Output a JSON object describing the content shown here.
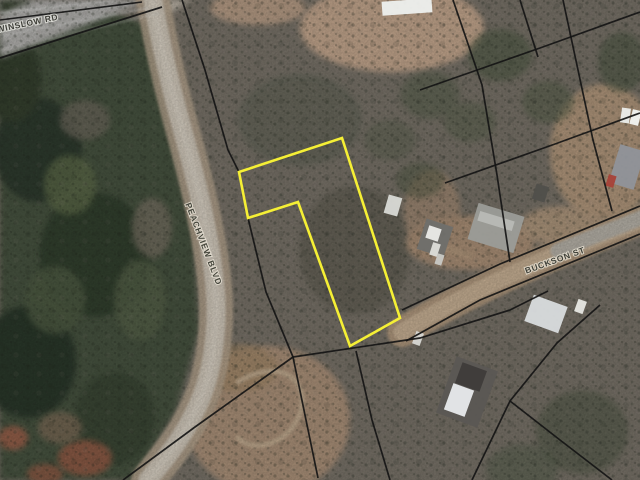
{
  "map": {
    "width": 640,
    "height": 480,
    "background": "#797369",
    "boundary_color": "#151515",
    "highlight_color": "#f5ef35",
    "labels": [
      {
        "name": "road-label-winslow",
        "text": "WINSLOW RD",
        "x": 28,
        "y": 26,
        "rotate": -12,
        "size": 8.5,
        "spacing": 0.6,
        "fill": "#3e3e38",
        "halo": "rgba(225,225,218,0.85)"
      },
      {
        "name": "road-label-peachview",
        "text": "PEACHVIEW BLVD",
        "x": 201,
        "y": 245,
        "rotate": 69,
        "size": 8.5,
        "spacing": 0.8,
        "fill": "#45463c",
        "halo": "rgba(232,226,214,0.8)"
      },
      {
        "name": "road-label-buckson",
        "text": "BUCKSON ST",
        "x": 556,
        "y": 263,
        "rotate": -20,
        "size": 8.5,
        "spacing": 0.7,
        "fill": "#3f4038",
        "halo": "rgba(233,226,212,0.8)"
      }
    ],
    "regions": [
      {
        "name": "forest-west",
        "type": "polygon",
        "points": "0,26 95,6 150,26 163,95 193,235 199,330 176,410 133,480 0,480",
        "fill": "#47523f",
        "opacity": 1
      },
      {
        "name": "forest-dark-blob",
        "type": "ellipse",
        "cx": 38,
        "cy": 150,
        "rx": 44,
        "ry": 52,
        "fill": "#2f3b2d",
        "opacity": 1
      },
      {
        "name": "forest-dark-blob",
        "type": "ellipse",
        "cx": 95,
        "cy": 255,
        "rx": 56,
        "ry": 62,
        "fill": "#333f2e",
        "opacity": 1
      },
      {
        "name": "forest-dark-blob",
        "type": "ellipse",
        "cx": 28,
        "cy": 362,
        "rx": 48,
        "ry": 56,
        "fill": "#2b372b",
        "opacity": 1
      },
      {
        "name": "forest-dark-blob",
        "type": "ellipse",
        "cx": 115,
        "cy": 418,
        "rx": 40,
        "ry": 46,
        "fill": "#3a4635",
        "opacity": 1
      },
      {
        "name": "forest-dark-blob",
        "type": "ellipse",
        "cx": 12,
        "cy": 80,
        "rx": 30,
        "ry": 42,
        "fill": "#36412f",
        "opacity": 1
      },
      {
        "name": "forest-light-blob",
        "type": "ellipse",
        "cx": 70,
        "cy": 185,
        "rx": 26,
        "ry": 30,
        "fill": "#5d6b48",
        "opacity": 0.8
      },
      {
        "name": "forest-light-blob",
        "type": "ellipse",
        "cx": 140,
        "cy": 300,
        "rx": 26,
        "ry": 40,
        "fill": "#57624a",
        "opacity": 0.8
      },
      {
        "name": "forest-light-blob",
        "type": "ellipse",
        "cx": 55,
        "cy": 300,
        "rx": 30,
        "ry": 34,
        "fill": "#4e5a43",
        "opacity": 0.9
      },
      {
        "name": "forest-grey-patch",
        "type": "ellipse",
        "cx": 85,
        "cy": 120,
        "rx": 25,
        "ry": 20,
        "fill": "#6c675c",
        "opacity": 0.8
      },
      {
        "name": "forest-grey-patch",
        "type": "ellipse",
        "cx": 152,
        "cy": 228,
        "rx": 20,
        "ry": 30,
        "fill": "#766f62",
        "opacity": 0.8
      },
      {
        "name": "red-trees",
        "type": "ellipse",
        "cx": 85,
        "cy": 458,
        "rx": 27,
        "ry": 18,
        "fill": "#8a5a45",
        "opacity": 1
      },
      {
        "name": "red-trees",
        "type": "ellipse",
        "cx": 13,
        "cy": 438,
        "rx": 15,
        "ry": 12,
        "fill": "#935f48",
        "opacity": 1
      },
      {
        "name": "red-trees",
        "type": "ellipse",
        "cx": 45,
        "cy": 474,
        "rx": 18,
        "ry": 10,
        "fill": "#8a5a45",
        "opacity": 0.9
      },
      {
        "name": "bare-patch",
        "type": "ellipse",
        "cx": 60,
        "cy": 428,
        "rx": 22,
        "ry": 16,
        "fill": "#7c6a56",
        "opacity": 0.8
      },
      {
        "name": "highway-surface",
        "type": "polygon",
        "points": "0,0 150,0 0,58",
        "fill": "#b2b1ae",
        "opacity": 1
      },
      {
        "name": "road-junction",
        "type": "polygon",
        "points": "146,0 192,0 168,14",
        "fill": "#bdb5a8",
        "opacity": 1
      },
      {
        "name": "corner-trees",
        "type": "polygon",
        "points": "0,0 34,0 0,14",
        "fill": "#3c4636",
        "opacity": 1
      },
      {
        "name": "field-top-middle",
        "type": "ellipse",
        "cx": 392,
        "cy": 28,
        "rx": 92,
        "ry": 44,
        "fill": "#c3a68d",
        "opacity": 1
      },
      {
        "name": "field-top-left",
        "type": "ellipse",
        "cx": 258,
        "cy": 8,
        "rx": 48,
        "ry": 17,
        "fill": "#bda189",
        "opacity": 0.9
      },
      {
        "name": "scrub-mid",
        "type": "ellipse",
        "cx": 300,
        "cy": 120,
        "rx": 62,
        "ry": 46,
        "fill": "#5c6152",
        "opacity": 0.55
      },
      {
        "name": "scrub-mid",
        "type": "ellipse",
        "cx": 355,
        "cy": 250,
        "rx": 56,
        "ry": 64,
        "fill": "#56544a",
        "opacity": 0.5
      },
      {
        "name": "yard-right",
        "type": "ellipse",
        "cx": 604,
        "cy": 152,
        "rx": 54,
        "ry": 68,
        "fill": "#b1977c",
        "opacity": 1
      },
      {
        "name": "yard-buckson",
        "type": "ellipse",
        "cx": 470,
        "cy": 243,
        "rx": 64,
        "ry": 27,
        "fill": "#ab9077",
        "opacity": 1
      },
      {
        "name": "yard-buckson",
        "type": "ellipse",
        "cx": 432,
        "cy": 212,
        "rx": 28,
        "ry": 42,
        "fill": "#a78d74",
        "opacity": 0.75
      },
      {
        "name": "yard-right",
        "type": "ellipse",
        "cx": 562,
        "cy": 226,
        "rx": 42,
        "ry": 20,
        "fill": "#b39a7f",
        "opacity": 0.9
      },
      {
        "name": "ne-trees",
        "type": "ellipse",
        "cx": 500,
        "cy": 55,
        "rx": 32,
        "ry": 26,
        "fill": "#4f5a44",
        "opacity": 0.65
      },
      {
        "name": "ne-trees",
        "type": "ellipse",
        "cx": 548,
        "cy": 102,
        "rx": 26,
        "ry": 21,
        "fill": "#525d47",
        "opacity": 0.55
      },
      {
        "name": "ne-trees",
        "type": "ellipse",
        "cx": 622,
        "cy": 62,
        "rx": 24,
        "ry": 30,
        "fill": "#4c5742",
        "opacity": 0.6
      },
      {
        "name": "ne-trees",
        "type": "ellipse",
        "cx": 470,
        "cy": 122,
        "rx": 26,
        "ry": 20,
        "fill": "#555f4a",
        "opacity": 0.5
      },
      {
        "name": "mid-trees",
        "type": "ellipse",
        "cx": 430,
        "cy": 95,
        "rx": 30,
        "ry": 24,
        "fill": "#515c47",
        "opacity": 0.5
      },
      {
        "name": "mid-trees",
        "type": "ellipse",
        "cx": 390,
        "cy": 140,
        "rx": 26,
        "ry": 20,
        "fill": "#565f4c",
        "opacity": 0.45
      },
      {
        "name": "mid-trees",
        "type": "ellipse",
        "cx": 420,
        "cy": 180,
        "rx": 24,
        "ry": 18,
        "fill": "#4f5943",
        "opacity": 0.5
      },
      {
        "name": "clearing-bottom",
        "type": "ellipse",
        "cx": 268,
        "cy": 420,
        "rx": 82,
        "ry": 74,
        "fill": "#ab9179",
        "opacity": 1
      },
      {
        "name": "clearing-bottom",
        "type": "ellipse",
        "cx": 238,
        "cy": 368,
        "rx": 40,
        "ry": 24,
        "fill": "#a08666",
        "opacity": 0.7
      },
      {
        "name": "se-trees",
        "type": "ellipse",
        "cx": 582,
        "cy": 432,
        "rx": 46,
        "ry": 42,
        "fill": "#4a5340",
        "opacity": 0.5
      },
      {
        "name": "se-trees",
        "type": "ellipse",
        "cx": 522,
        "cy": 470,
        "rx": 36,
        "ry": 26,
        "fill": "#515c48",
        "opacity": 0.5
      }
    ],
    "roads": [
      {
        "name": "road-peachview-blvd",
        "layers": [
          {
            "d": "M152,-4 C160,40 170,85 182,128 C194,172 205,215 211,255 C216,288 218,312 214,345 C210,378 202,400 188,425 C176,446 162,463 148,480",
            "stroke": "#b5a48e",
            "width": 34,
            "opacity": 0.85
          },
          {
            "d": "M152,-4 C160,40 170,85 182,128 C194,172 205,215 211,255 C216,288 218,312 214,345 C210,378 202,400 188,425 C176,446 162,463 148,480",
            "stroke": "#d3cbbd",
            "width": 19,
            "opacity": 0.95
          },
          {
            "d": "M152,-4 C160,40 170,85 182,128 C194,172 205,215 211,255 C216,288 218,312 214,345 C210,378 202,400 188,425 C176,446 162,463 148,480",
            "stroke": "#e0d9cc",
            "width": 7,
            "opacity": 0.5
          }
        ]
      },
      {
        "name": "road-buckson-st",
        "layers": [
          {
            "d": "M646,218 C560,252 480,285 402,332",
            "stroke": "#b59c80",
            "width": 30,
            "opacity": 0.9
          },
          {
            "d": "M646,218 C560,252 480,285 402,332",
            "stroke": "#c9b296",
            "width": 17,
            "opacity": 0.95
          },
          {
            "d": "M646,216 C614,229 584,240 558,251",
            "stroke": "#b6b3ab",
            "width": 15,
            "opacity": 0.9
          }
        ]
      },
      {
        "name": "highway-lane-stripes",
        "layers": [
          {
            "d": "M0,13 L118,0",
            "stroke": "#e4e4e2",
            "width": 1.3,
            "opacity": 0.9
          },
          {
            "d": "M0,36 L148,8",
            "stroke": "#dcdcda",
            "width": 1.2,
            "opacity": 0.8
          },
          {
            "d": "M0,50 L160,13",
            "stroke": "#d0d0cc",
            "width": 1.0,
            "opacity": 0.7
          }
        ]
      },
      {
        "name": "dirt-track",
        "layers": [
          {
            "d": "M238,382 C288,352 315,390 296,422 C282,446 252,452 238,438",
            "stroke": "#c3ad92",
            "width": 5,
            "opacity": 0.9
          }
        ]
      },
      {
        "name": "driveway-buckson",
        "layers": [
          {
            "d": "M470,256 C452,250 440,247 426,242",
            "stroke": "#b49a7e",
            "width": 7,
            "opacity": 0.8
          }
        ]
      },
      {
        "name": "driveway-right",
        "layers": [
          {
            "d": "M612,208 C616,196 618,188 617,180",
            "stroke": "#b49a7e",
            "width": 6,
            "opacity": 0.7
          }
        ]
      }
    ],
    "parcel_lines": [
      {
        "points": "0,20 142,2",
        "width": 1.6
      },
      {
        "points": "0,58 162,7",
        "width": 1.8
      },
      {
        "points": "182,0 205,70 228,150 239,172",
        "width": 1.7
      },
      {
        "points": "248,218 266,292 293,357",
        "width": 1.7
      },
      {
        "points": "293,357 318,478",
        "width": 1.7
      },
      {
        "points": "293,357 195,427 123,480",
        "width": 1.7
      },
      {
        "points": "293,357 420,338 510,310 548,291",
        "width": 1.7
      },
      {
        "points": "356,351 372,420 390,480",
        "width": 1.7
      },
      {
        "points": "600,305 557,343 510,401 472,480",
        "width": 1.7
      },
      {
        "points": "510,401 560,440 612,480",
        "width": 1.7
      },
      {
        "points": "640,206 500,264 402,310",
        "width": 1.7
      },
      {
        "points": "640,234 480,300 406,341",
        "width": 1.7
      },
      {
        "points": "453,0 482,85 497,175 510,262",
        "width": 1.7
      },
      {
        "points": "520,0 538,57",
        "width": 1.7
      },
      {
        "points": "563,0 593,140 612,211",
        "width": 1.7
      },
      {
        "points": "420,90 540,48 640,12",
        "width": 1.7
      },
      {
        "points": "445,183 555,144 640,113",
        "width": 1.7
      }
    ],
    "highlight_parcel": {
      "name": "highlighted-parcel",
      "points": "342,138 400,318 350,346 298,202 248,218 239,172",
      "stroke_width": 2.6
    },
    "buildings": [
      {
        "name": "building-barn",
        "x": 382,
        "y": 0,
        "w": 50,
        "h": 14,
        "rot": -4,
        "fill": "#eef0ee"
      },
      {
        "name": "building-shed",
        "x": 386,
        "y": 196,
        "w": 14,
        "h": 19,
        "rot": 16,
        "fill": "#d9dad6"
      },
      {
        "name": "building-house-mid",
        "x": 421,
        "y": 222,
        "w": 28,
        "h": 32,
        "rot": 18,
        "fill": "#6f6f6b"
      },
      {
        "name": "building-house-mid-wing",
        "x": 427,
        "y": 227,
        "w": 13,
        "h": 13,
        "rot": 18,
        "fill": "#ebebe9"
      },
      {
        "name": "vehicle-white",
        "x": 431,
        "y": 243,
        "w": 8,
        "h": 13,
        "rot": 18,
        "fill": "#ddddd9"
      },
      {
        "name": "vehicle-white",
        "x": 436,
        "y": 254,
        "w": 7,
        "h": 11,
        "rot": 18,
        "fill": "#c9c9c5"
      },
      {
        "name": "building-house-grey",
        "x": 472,
        "y": 209,
        "w": 48,
        "h": 38,
        "rot": 17,
        "fill": "#9b9c98"
      },
      {
        "name": "building-house-grey-ridge",
        "x": 478,
        "y": 216,
        "w": 36,
        "h": 10,
        "rot": 17,
        "fill": "#b8b9b5"
      },
      {
        "name": "building-shed-dark",
        "x": 534,
        "y": 185,
        "w": 13,
        "h": 16,
        "rot": 17,
        "fill": "#504f4b"
      },
      {
        "name": "building-house-right",
        "x": 614,
        "y": 147,
        "w": 26,
        "h": 40,
        "rot": 17,
        "fill": "#90949a"
      },
      {
        "name": "vehicle-white",
        "x": 621,
        "y": 108,
        "w": 9,
        "h": 15,
        "rot": 8,
        "fill": "#eceeec"
      },
      {
        "name": "vehicle-white",
        "x": 631,
        "y": 110,
        "w": 9,
        "h": 15,
        "rot": 14,
        "fill": "#f2f4f2"
      },
      {
        "name": "vehicle-red",
        "x": 607,
        "y": 175,
        "w": 8,
        "h": 12,
        "rot": 17,
        "fill": "#a84238"
      },
      {
        "name": "building-house-ne",
        "x": 528,
        "y": 300,
        "w": 36,
        "h": 28,
        "rot": 20,
        "fill": "#d9dcde"
      },
      {
        "name": "building-trailer",
        "x": 574,
        "y": 302,
        "w": 13,
        "h": 9,
        "rot": -70,
        "fill": "#e8e8e4"
      },
      {
        "name": "building-house-bottom",
        "x": 445,
        "y": 362,
        "w": 44,
        "h": 60,
        "rot": 20,
        "fill": "#5b5754"
      },
      {
        "name": "building-house-bottom-dark-wing",
        "x": 458,
        "y": 366,
        "w": 26,
        "h": 22,
        "rot": 20,
        "fill": "#3f3c3a"
      },
      {
        "name": "building-house-bottom-white-wing",
        "x": 448,
        "y": 386,
        "w": 22,
        "h": 28,
        "rot": 20,
        "fill": "#e9ebed"
      },
      {
        "name": "vehicle-white",
        "x": 414,
        "y": 332,
        "w": 8,
        "h": 13,
        "rot": 20,
        "fill": "#d8d8d4"
      }
    ]
  }
}
